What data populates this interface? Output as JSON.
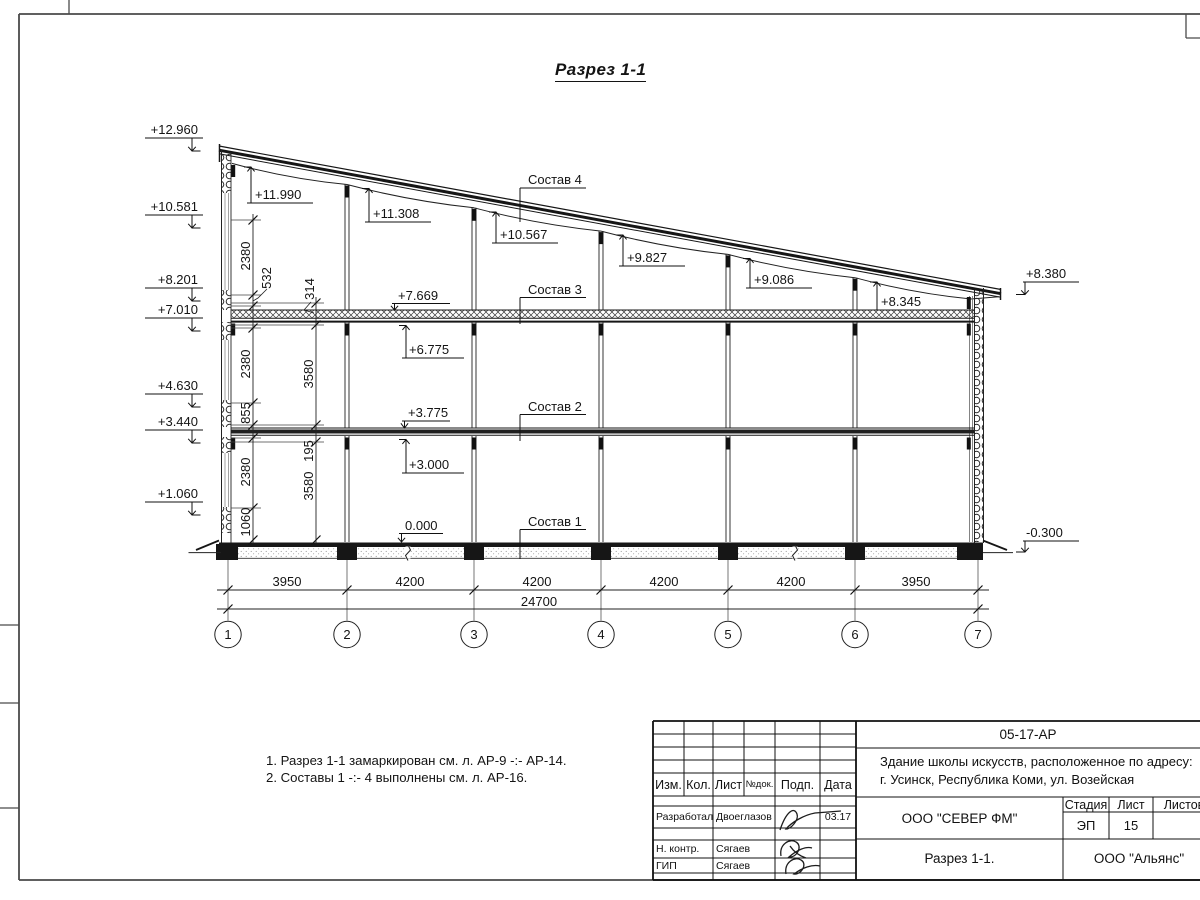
{
  "drawing": {
    "title": "Разрез 1-1",
    "elevations_left": [
      "+12.960",
      "+10.581",
      "+8.201",
      "+7.010",
      "+4.630",
      "+3.440",
      "+1.060"
    ],
    "elevations_roof": [
      "+11.990",
      "+11.308",
      "+10.567",
      "+9.827",
      "+9.086",
      "+8.345"
    ],
    "elevations_floor_down": [
      "+7.669",
      "+3.775",
      "0.000"
    ],
    "elevations_floor_up": [
      "+6.775",
      "+3.000"
    ],
    "elevation_right_top": "+8.380",
    "elevation_right_bottom": "-0.300",
    "composition_labels": [
      "Состав 4",
      "Состав 3",
      "Состав 2",
      "Состав 1"
    ],
    "dims_chain_outer": [
      "2380",
      "532",
      "2380",
      "855",
      "2380",
      "1060"
    ],
    "dims_chain_inner": [
      "314",
      "3580",
      "195",
      "3580"
    ],
    "dims_bottom": [
      "3950",
      "4200",
      "4200",
      "4200",
      "4200",
      "3950"
    ],
    "dim_total": "24700",
    "axes": [
      "1",
      "2",
      "3",
      "4",
      "5",
      "6",
      "7"
    ],
    "notes": [
      "1. Разрез 1-1 замаркирован см. л. АР-9 -:- АР-14.",
      "2. Составы 1 -:- 4 выполнены см. л. АР-16."
    ]
  },
  "titleblock": {
    "doc_number": "05-17-АР",
    "project_line1": "Здание школы искусств, расположенное по адресу:",
    "project_line2": "г. Усинск, Республика Коми, ул. Возейская",
    "columns": {
      "izm": "Изм.",
      "kol": "Кол.",
      "list": "Лист",
      "ndok": "№док.",
      "podp": "Подп.",
      "data": "Дата"
    },
    "rows": [
      {
        "role": "Разработал",
        "name": "Двоеглазов",
        "date": "03.17"
      },
      {
        "role": "Н. контр.",
        "name": "Сягаев",
        "date": ""
      },
      {
        "role": "ГИП",
        "name": "Сягаев",
        "date": ""
      }
    ],
    "company": "ООО \"СЕВЕР ФМ\"",
    "stage_label": "Стадия",
    "stage": "ЭП",
    "sheet_label": "Лист",
    "sheet": "15",
    "sheets_label": "Листов",
    "sheet_title": "Разрез 1-1.",
    "contractor": "ООО \"Альянс\""
  }
}
